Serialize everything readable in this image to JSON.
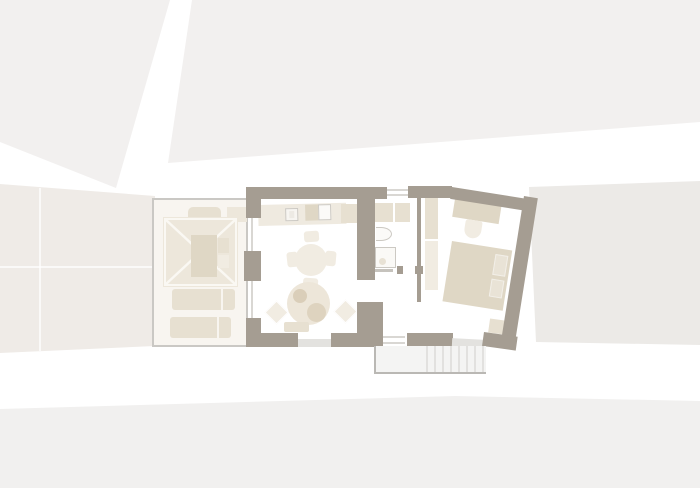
{
  "scene": {
    "kind": "architectural-floor-plan-top-view",
    "rooms": [
      "terrace",
      "living-kitchen-room",
      "bathroom",
      "hallway",
      "bedroom"
    ],
    "exterior_elements": [
      "site-background-blocks",
      "exterior-staircase"
    ],
    "furniture": {
      "terrace": [
        "pergola-canopy",
        "pergola-table",
        "garden-bench",
        "sun-lounger",
        "sun-lounger"
      ],
      "living-kitchen-room": [
        "kitchen-counter",
        "sink",
        "cooktop",
        "dining-table-round",
        "dining-chairs-x4",
        "lounge-table-round",
        "diamond-chairs-x2",
        "bench"
      ],
      "bathroom": [
        "shower-closet",
        "wash-basin",
        "shower-tray"
      ],
      "bedroom": [
        "wardrobe",
        "desk",
        "desk-chair",
        "double-bed",
        "pillows-x2",
        "nightstand"
      ]
    }
  },
  "colors": {
    "canvas": "#FFFFFF",
    "band-top": "#F2F0EF",
    "band-left": "#EFEBE7",
    "band-right": "#ECEAE7",
    "band-bottom": "#F1F0EF",
    "grid-line": "#FFFFFF",
    "wall": "#A59D92",
    "outline": "#CAC8C4",
    "terrace-floor": "#F8F5F0",
    "furniture-dark": "#DFD7C5",
    "furniture-mid": "#E7E0D1",
    "furniture-soft": "#EDE7DB",
    "furniture-light": "#F1ECE2",
    "plate-dark": "#DACEB9",
    "plate-mid": "#DED3BF",
    "threshold": "#E3E2DF",
    "frame-line": "#D9D7D3",
    "fixture-border": "#CCC9C3",
    "fixture-fill": "#FBFAF8",
    "stair-fill": "#F4F4F3",
    "stair-line": "#E2E1DF",
    "stair-rail": "#BAB8B4"
  }
}
